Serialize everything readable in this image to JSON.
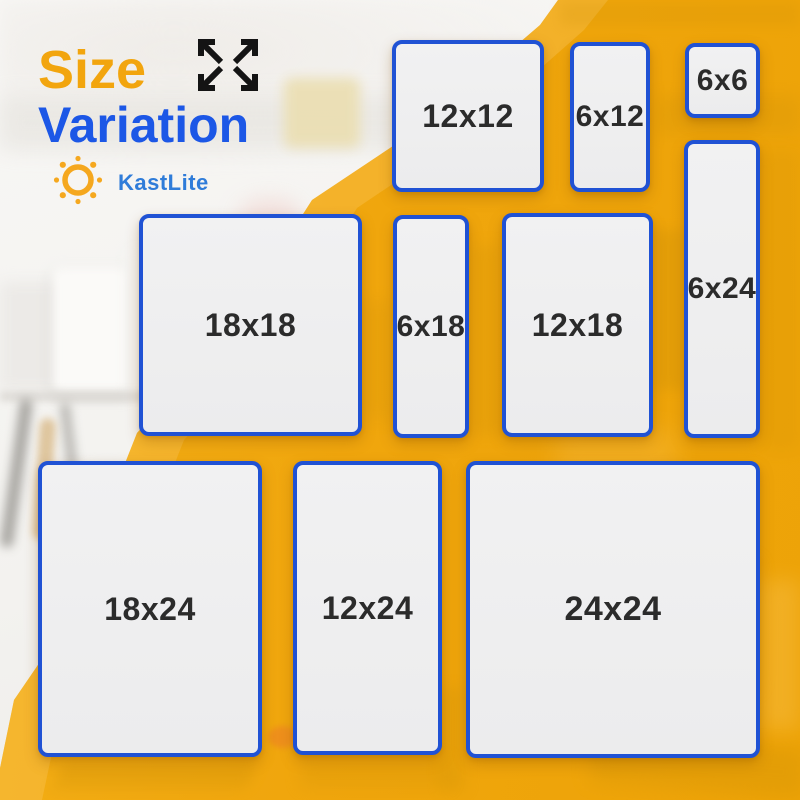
{
  "title": {
    "line1": "Size",
    "line2": "Variation"
  },
  "brand": {
    "name": "KastLite"
  },
  "icons": {
    "expand": "expand-arrows-icon (four black arrows pointing outward)",
    "sun": "sun-icon (orange ring with ray dots)"
  },
  "panels": [
    {
      "label": "12x12",
      "x": 392,
      "y": 40,
      "w": 152,
      "h": 152
    },
    {
      "label": "6x12",
      "x": 570,
      "y": 42,
      "w": 80,
      "h": 150
    },
    {
      "label": "6x6",
      "x": 685,
      "y": 43,
      "w": 75,
      "h": 75
    },
    {
      "label": "6x24",
      "x": 684,
      "y": 140,
      "w": 76,
      "h": 298
    },
    {
      "label": "18x18",
      "x": 139,
      "y": 214,
      "w": 223,
      "h": 222
    },
    {
      "label": "6x18",
      "x": 393,
      "y": 215,
      "w": 76,
      "h": 223
    },
    {
      "label": "12x18",
      "x": 502,
      "y": 213,
      "w": 151,
      "h": 224
    },
    {
      "label": "18x24",
      "x": 38,
      "y": 461,
      "w": 224,
      "h": 296
    },
    {
      "label": "12x24",
      "x": 293,
      "y": 461,
      "w": 149,
      "h": 294
    },
    {
      "label": "24x24",
      "x": 466,
      "y": 461,
      "w": 294,
      "h": 297
    }
  ],
  "colors": {
    "bg-yellow": "#F0A60D",
    "yellow-highlight": "#F8C14E",
    "panel-fill": "#EFEFEF",
    "panel-border": "#2052D4",
    "label-color": "#2B2B2B",
    "title-amber": "#F2A50E",
    "title-blue": "#1C57E6",
    "brand-blue": "#2F7CD9",
    "arrow-black": "#141414",
    "sun-orange": "#F5A81F"
  }
}
